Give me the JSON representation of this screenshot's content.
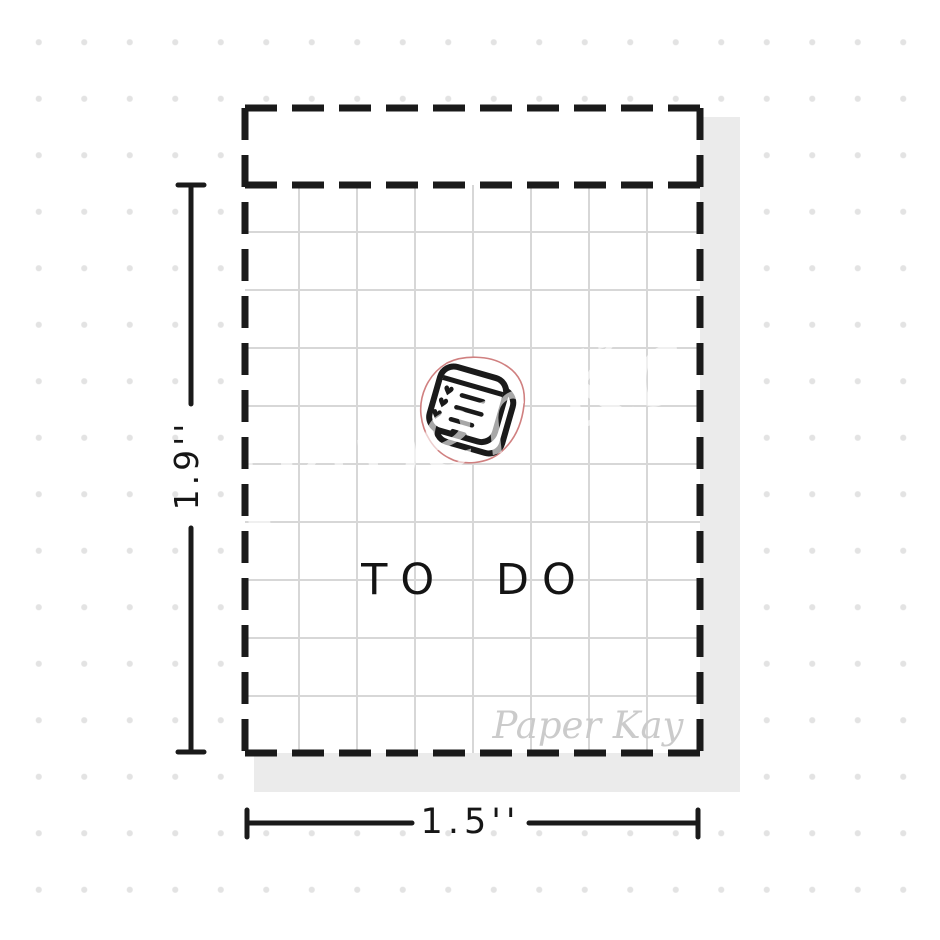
{
  "product_mockup": {
    "sticker_text": "TO DO",
    "height_label": "1.9''",
    "width_label": "1.5''",
    "brand_signature": "Paper Kay",
    "large_watermark": "Paper Kay",
    "icon": "todo-notepad-doodle",
    "colors": {
      "ink_black": "#1a1a1a",
      "kiss_cut_pink": "#d08080",
      "grid_line_gray": "#d7d7d7",
      "background_dot_gray": "#e3e3e3",
      "sheet_shadow_gray": "#ebebeb",
      "signature_gray": "#cbcbcb"
    }
  }
}
